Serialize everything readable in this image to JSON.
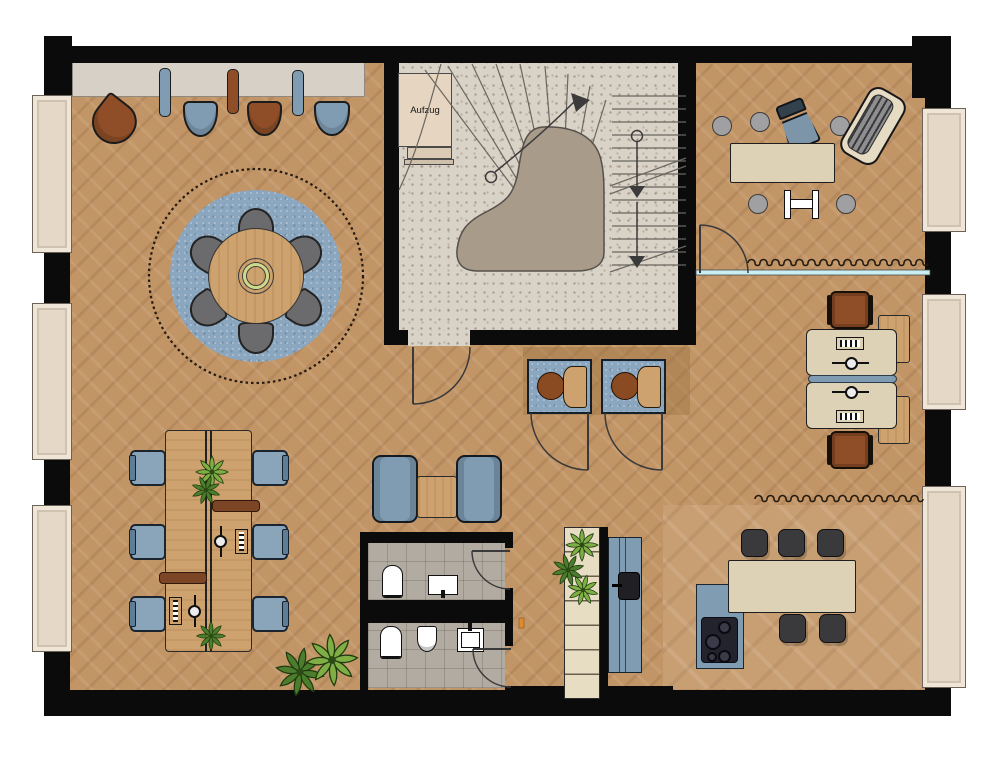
{
  "plan": {
    "elevator_label": "Aufzug"
  },
  "theme_colors": {
    "wall": "#0b0b0b",
    "floor_wood": "#c29566",
    "floor_kitchen": "#c89f73",
    "stair_floor": "#d9d2c7",
    "stair_landing": "#a89b8a",
    "tile_floor": "#b2aba1",
    "rug_blue": "#8ba6bf",
    "furniture_blue": "#7f9cb3",
    "furniture_blue_dark": "#5e7e97",
    "leather_brown": "#8f4e27",
    "wood_light": "#cda26e",
    "wood_dark": "#7c4a27",
    "desk_beige": "#ddd2b6",
    "bench_gray": "#d6d0c6",
    "window_frame": "#e5d8c6",
    "chair_gray": "#6b6b6d",
    "stool_black": "#3a3a3c",
    "glass_cyan": "#c9eff2",
    "plant_green": "#4c7d2c",
    "plant_green_light": "#7fae45",
    "line_dark": "#2f2f2f",
    "door_orange": "#e08a2d"
  }
}
